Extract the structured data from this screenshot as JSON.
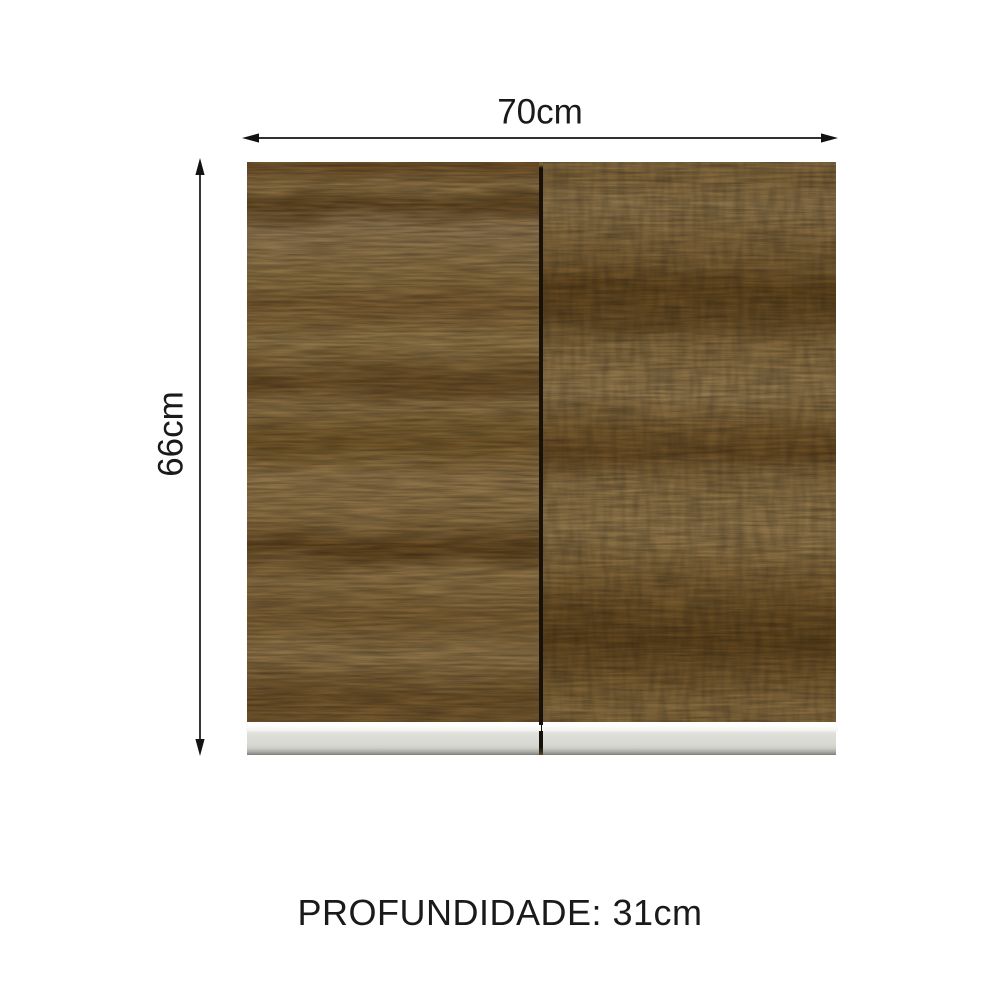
{
  "diagram": {
    "width_label": "70cm",
    "height_label": "66cm",
    "depth_label": "PROFUNDIDADE: 31cm",
    "doors": [
      "left",
      "right"
    ],
    "colors": {
      "wood_base": "#8d7245",
      "wood_dark_grain": "#5f4424",
      "wood_light": "#a28457",
      "door_gap": "#17110a",
      "handle_highlight": "#fafaf8",
      "handle_body": "#d9d9d4",
      "handle_shadow": "#8f8f89",
      "dimension_ink": "#121212",
      "text_ink": "#1a1a1a",
      "page_bg": "#ffffff"
    }
  }
}
